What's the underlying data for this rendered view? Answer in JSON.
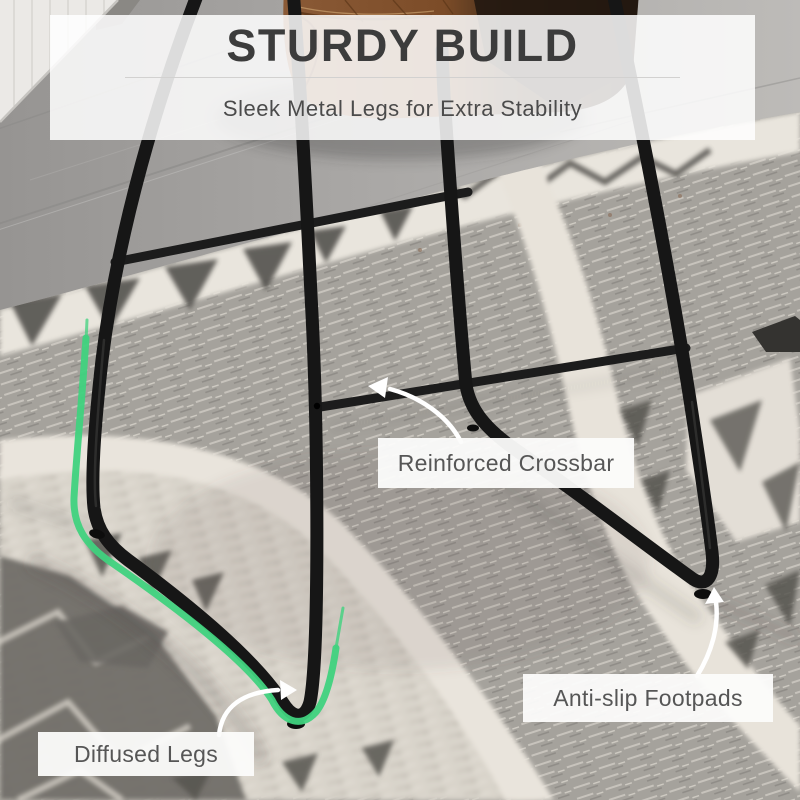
{
  "header": {
    "title": "STURDY BUILD",
    "subtitle": "Sleek Metal Legs for Extra Stability"
  },
  "callouts": {
    "crossbar": {
      "label": "Reinforced Crossbar"
    },
    "footpads": {
      "label": "Anti-slip Footpads"
    },
    "diffused": {
      "label": "Diffused Legs"
    }
  },
  "colors": {
    "accent_green": "#40d27e",
    "frame_black": "#1a1a1a",
    "arrow_white": "#ffffff",
    "title_text": "#3c3c3c",
    "label_text": "#565656"
  }
}
